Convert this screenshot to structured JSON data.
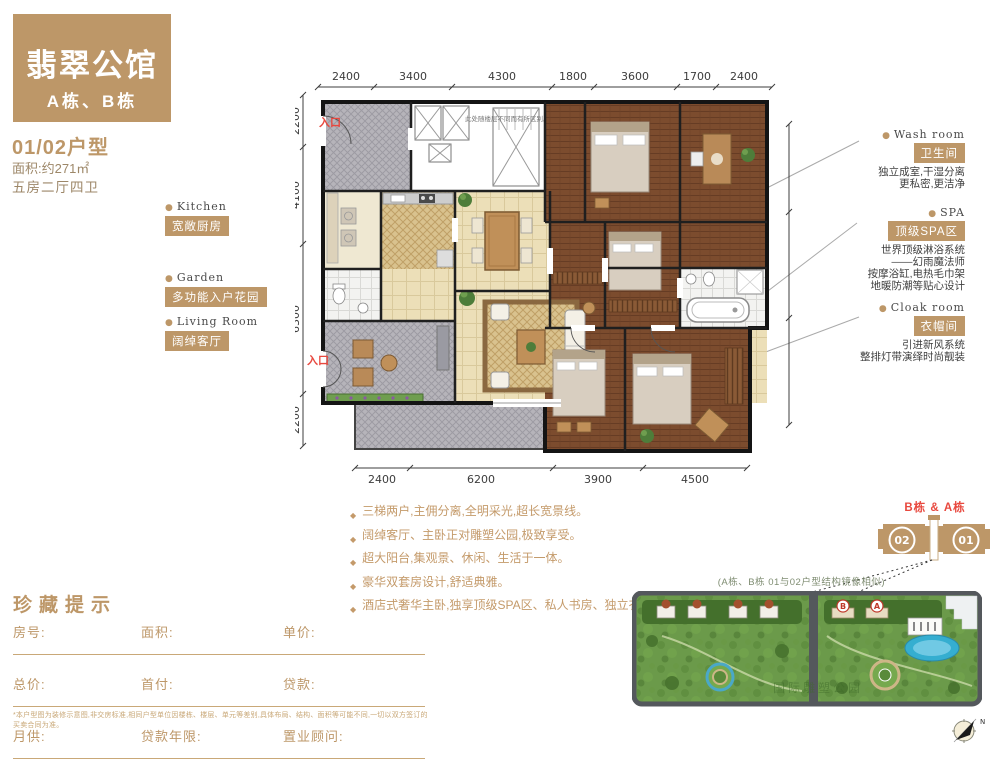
{
  "header": {
    "project_title": "翡翠公馆",
    "buildings": "A栋、B栋",
    "unit_type": "01/02户型",
    "area_line": "面积:约271㎡",
    "layout_line": "五房二厅四卫"
  },
  "features_left": [
    {
      "en": "Kitchen",
      "zh": "宽敞厨房"
    },
    {
      "en": "Garden",
      "zh": "多功能入户花园"
    },
    {
      "en": "Living Room",
      "zh": "阔绰客厅"
    }
  ],
  "features_right": [
    {
      "en": "Wash room",
      "zh": "卫生间",
      "desc": [
        "独立成室,干湿分离",
        "更私密,更洁净"
      ]
    },
    {
      "en": "SPA",
      "zh": "顶级SPA区",
      "desc": [
        "世界顶级淋浴系统",
        "——幻雨魔法师",
        "按摩浴缸,电热毛巾架",
        "地暖防潮等贴心设计"
      ]
    },
    {
      "en": "Cloak room",
      "zh": "衣帽间",
      "desc": [
        "引进新风系统",
        "整排灯带演绎时尚靓装"
      ]
    }
  ],
  "floorplan": {
    "entrance_label": "入口",
    "entrance_label_2": "入口",
    "floor_note": "此处随楼层不同而有所区别。",
    "dims_top": [
      "2400",
      "3400",
      "4300",
      "1800",
      "3600",
      "1700",
      "2400"
    ],
    "dims_left": [
      "2200",
      "4100",
      "6300",
      "2200"
    ],
    "dims_right": [
      "3800",
      "4600",
      "4600"
    ],
    "dims_bottom": [
      "2400",
      "6200",
      "3900",
      "4500"
    ]
  },
  "selling_points": [
    "三梯两户,主佣分离,全明采光,超长宽景线。",
    "阔绰客厅、主卧正对雕塑公园,极致享受。",
    "超大阳台,集观景、休闲、生活于一体。",
    "豪华双套房设计,舒适典雅。",
    "酒店式奢华主卧,独享顶级SPA区、私人书房、独立衣帽间、卫生间。"
  ],
  "form": {
    "title": "珍藏提示",
    "rows": [
      [
        "房号:",
        "面积:",
        "单价:"
      ],
      [
        "总价:",
        "首付:",
        "贷款:"
      ],
      [
        "月供:",
        "贷款年限:",
        "置业顾问:"
      ]
    ],
    "footnote": "*本户型图为装修示意图,非交房标准,相同户型单位因楼栋、楼层、单元等差别,具体布局、结构、面积等可能不同,一切以双方签订的买卖合同为准。"
  },
  "locator": {
    "building_label": "B栋 & A栋",
    "unit_left": "02",
    "unit_right": "01",
    "note": "(A栋、B栋 01与02户型结构镜像相似)",
    "site_watermark": "国际雕塑公园",
    "compass_letter": "N"
  },
  "colors": {
    "accent": "#bd9768",
    "red": "#e8483e",
    "wood": "#7c4c2e"
  }
}
